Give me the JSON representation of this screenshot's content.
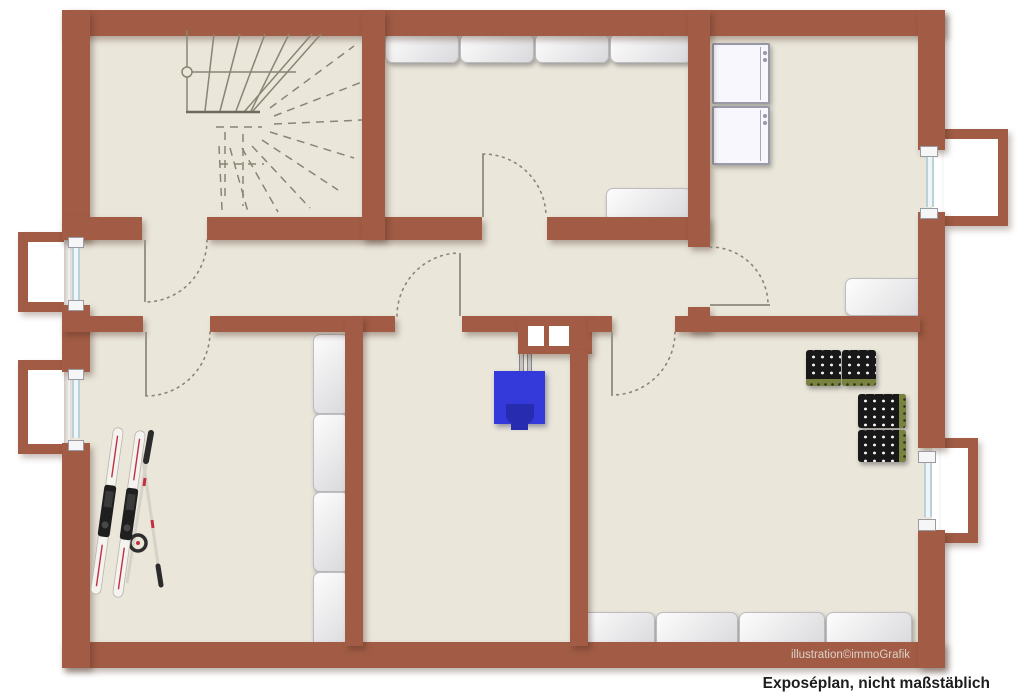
{
  "captions": {
    "watermark": "illustration©immoGrafik",
    "disclaimer": "Exposéplan, nicht maßstäblich"
  },
  "palette": {
    "wall": "#a25c45",
    "floor": "#eae6da",
    "outside": "#ffffff",
    "boiler_blue": "#3439da",
    "boiler_dark_blue": "#272bb0",
    "crate_dark": "#181818",
    "crate_accent_green": "#79823f",
    "stair_and_door_line_gray": "#8a8472",
    "window_glazing": "#eef6f8"
  },
  "plan": {
    "type": "basement floor plan illustration",
    "symbols": [
      {
        "name": "winder-staircase",
        "style": "solid upper flight, dashed lower flight",
        "location": "top-left room"
      },
      {
        "name": "shelf-row",
        "units": 4,
        "location": "top wall of top-middle room"
      },
      {
        "name": "cabinet",
        "units": 1,
        "location": "top-middle room bottom-right corner"
      },
      {
        "name": "washing-machine",
        "units": 1,
        "location": "laundry room top-left"
      },
      {
        "name": "dryer",
        "units": 1,
        "location": "laundry room, below washing machine"
      },
      {
        "name": "cabinet",
        "units": 1,
        "location": "laundry room bottom-right"
      },
      {
        "name": "window-with-light-well",
        "units": 4,
        "location": "two on left wall, two on right wall"
      },
      {
        "name": "door-swing",
        "units": 6,
        "location": "stair room, ski room, boiler room, top-middle room, laundry room, bottom-right room"
      },
      {
        "name": "chimney-with-two-flues",
        "units": 1,
        "location": "center dividing wall"
      },
      {
        "name": "boiler",
        "units": 1,
        "location": "boiler room, connected to chimney by two pipes"
      },
      {
        "name": "shelf-column",
        "units": 4,
        "location": "ski room along dividing wall"
      },
      {
        "name": "skis-with-poles",
        "units": 1,
        "location": "ski room bottom-left"
      },
      {
        "name": "beverage-crates",
        "units": 4,
        "location": "bottom-right room"
      },
      {
        "name": "shelf-row",
        "units": 4,
        "location": "bottom wall of bottom-right room"
      }
    ]
  }
}
